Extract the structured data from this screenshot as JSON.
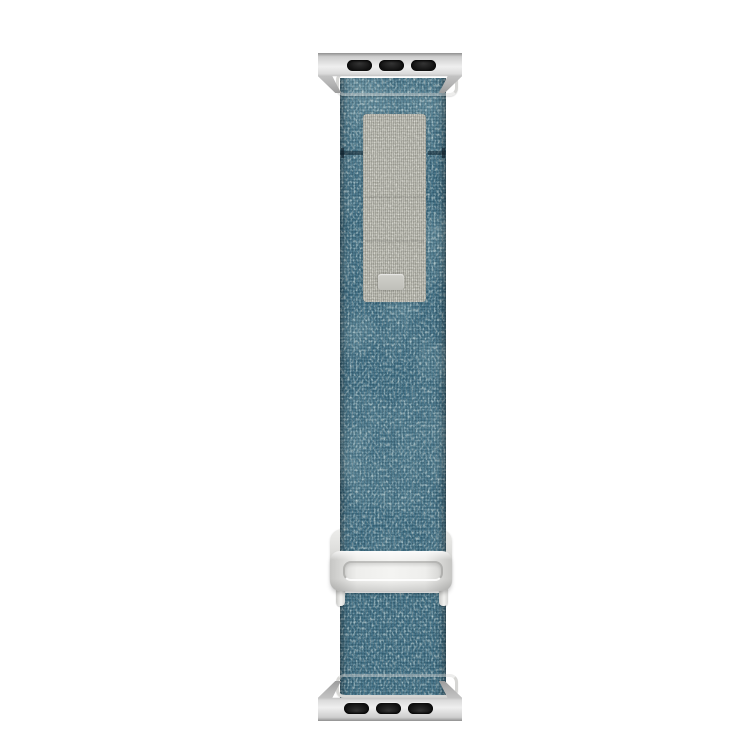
{
  "meta": {
    "type": "product-photo",
    "subject": "Blue heathered fabric smartwatch band with silver hardware",
    "background_color": "#ffffff"
  },
  "colors": {
    "fabric_base": "#3a6a80",
    "fabric_light_fleck": "#bcd2d0",
    "fabric_dark_fleck": "#1d3c4e",
    "loop_panel": "#b3b3a9",
    "loop_panel_light": "#d8d8cf",
    "loop_tab": "#c8c8c2",
    "metal_light": "#f1f1ef",
    "metal_mid": "#d6d6d4",
    "metal_dark": "#9a9a9a",
    "slot": "#141414"
  },
  "parts": {
    "photo": "Fabric watch band product photo",
    "top_lug": "Top metal lug adapter with three slots",
    "top_clamp": "Top metal strap clamp",
    "upper_strap": "Upper blue woven fabric strap",
    "loop_panel": "Gray hook-and-loop fastening panel",
    "loop_tab": "Embossed tab on loop panel",
    "stitch_seam": "Horizontal stitch seam",
    "buckle": "Silver slide buckle (G-hook)",
    "buckle_slot": "Buckle strap slot",
    "post_left": "Left buckle post",
    "post_right": "Right buckle post",
    "lower_strap": "Lower blue woven fabric strap",
    "bottom_clamp": "Bottom metal strap clamp",
    "bottom_lug": "Bottom metal lug adapter with three slots"
  }
}
